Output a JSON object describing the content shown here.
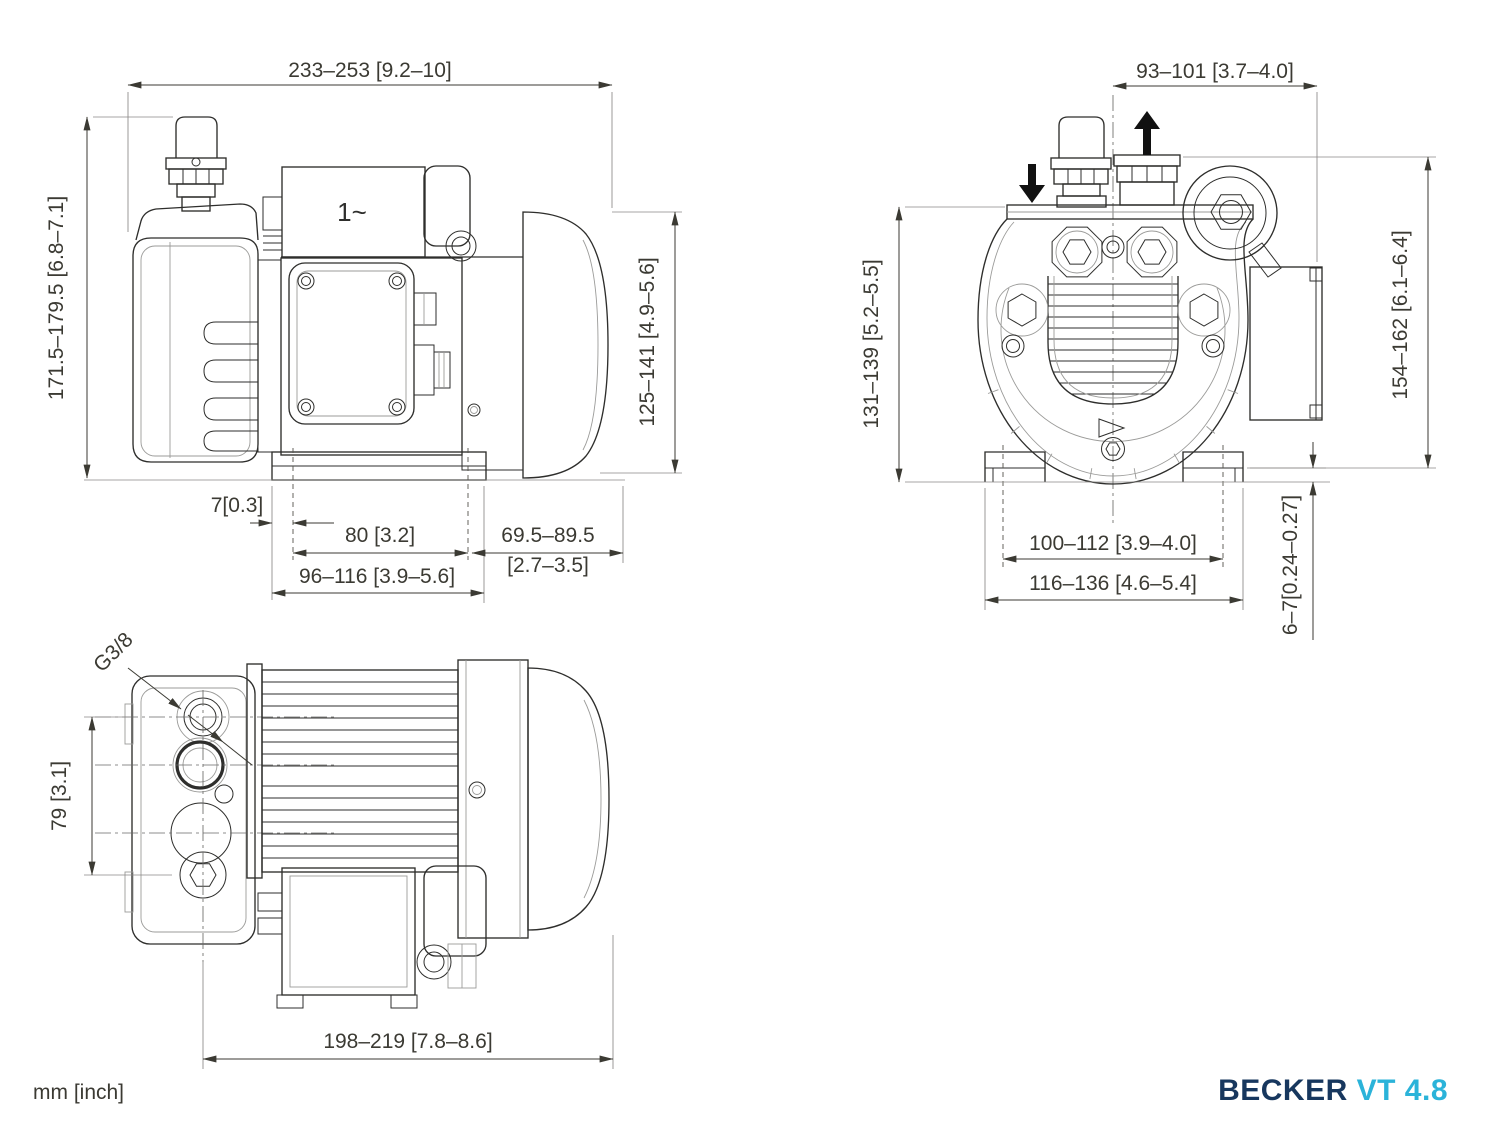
{
  "footer": {
    "units": "mm [inch]"
  },
  "brand": {
    "name": "BECKER",
    "model": "VT 4.8",
    "name_color": "#17375e",
    "model_color": "#2bb3d9"
  },
  "side_view": {
    "motor_phase_label": "1~",
    "dim_overall_length": "233–253 [9.2–10]",
    "dim_overall_height": "171.5–179.5 [6.8–7.1]",
    "dim_motor_diameter": "125–141 [4.9–5.6]",
    "dim_foot_edge_offset": "7[0.3]",
    "dim_foot_hole_spacing": "80 [3.2]",
    "dim_overhang_mm": "69.5–89.5",
    "dim_overhang_inch": "[2.7–3.5]",
    "dim_base_length": "96–116 [3.9–5.6]"
  },
  "front_view": {
    "dim_port_offset": "93–101 [3.7–4.0]",
    "dim_housing_height": "131–139 [5.2–5.5]",
    "dim_total_height": "154–162 [6.1–6.4]",
    "dim_foot_hole_spacing": "100–112 [3.9–4.0]",
    "dim_foot_width": "116–136 [4.6–5.4]",
    "dim_foot_slot_height": "6–7[0.24–0.27]"
  },
  "top_view": {
    "port_thread_label": "G3/8",
    "dim_port_spacing": "79 [3.1]",
    "dim_body_length": "198–219 [7.8–8.6]"
  }
}
